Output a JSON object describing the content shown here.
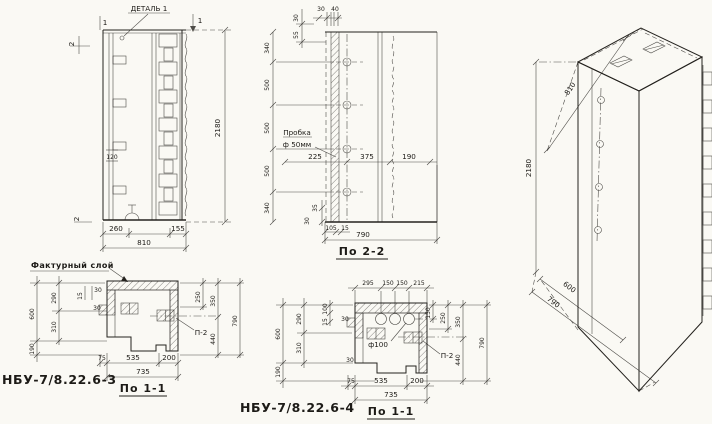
{
  "ink": "#24221e",
  "paper": "#faf9f4",
  "front": {
    "detail_callout": "ДЕТАЛЬ 1",
    "mark_1": "1",
    "mark_2": "2",
    "dim_height": "2180",
    "dim_120": "120",
    "dim_260": "260",
    "dim_155": "155",
    "dim_810": "810"
  },
  "section22": {
    "title": "По 2-2",
    "plug_line1": "Пробка",
    "plug_line2": "ф 50мм",
    "left_dims": [
      "340",
      "500",
      "500",
      "500",
      "340"
    ],
    "top_dims": [
      "30",
      "40"
    ],
    "top_left_dims": [
      "30",
      "55"
    ],
    "mid_dims": [
      "225",
      "375",
      "190"
    ],
    "bottom_small_dims": [
      "35",
      "30",
      "105",
      "15"
    ],
    "dim_total": "790"
  },
  "iso": {
    "dim_top": "810",
    "dim_height": "2180",
    "dim_600": "600",
    "dim_790": "790"
  },
  "plan3": {
    "part_label": "НБУ-7/8.22.6-3",
    "title": "По 1-1",
    "finish_callout": "Фактурный слой",
    "embed_label": "П-2",
    "left_outer_dims": [
      "600",
      "190"
    ],
    "left_inner_dims": [
      "290",
      "310"
    ],
    "small_dims": [
      "30",
      "15",
      "30"
    ],
    "right_dims": [
      "250",
      "350",
      "440",
      "790"
    ],
    "bottom_dims": [
      "75",
      "535",
      "200"
    ],
    "dim_total": "735"
  },
  "plan4": {
    "part_label": "НБУ-7/8.22.6-4",
    "title": "По 1-1",
    "hole_label": "ф100",
    "embed_label": "П-2",
    "top_dims": [
      "295",
      "150",
      "150",
      "215"
    ],
    "left_outer_dims": [
      "600",
      "190"
    ],
    "left_inner_dims": [
      "290",
      "310"
    ],
    "small_dims": [
      "100",
      "15",
      "30",
      "30"
    ],
    "right_small_dim": "150",
    "right_dims": [
      "250",
      "350",
      "440",
      "790"
    ],
    "bottom_dims": [
      "75",
      "535",
      "200"
    ],
    "dim_total": "735"
  }
}
